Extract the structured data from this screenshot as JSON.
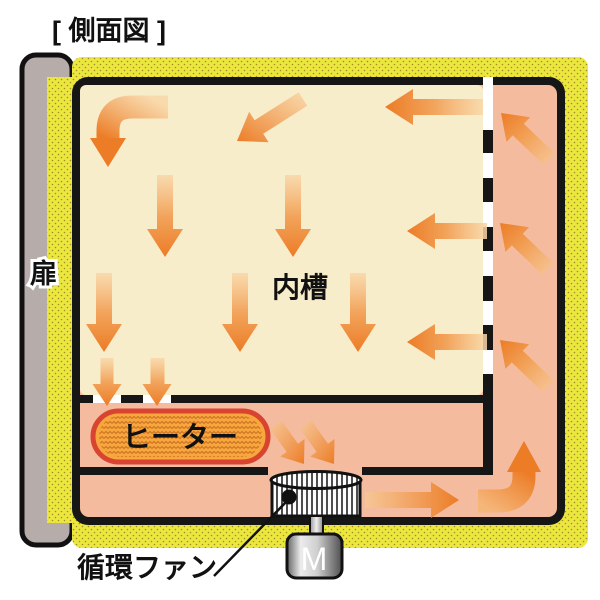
{
  "title": "[ 側面図 ]",
  "labels": {
    "door": "扉",
    "inner_chamber": "内槽",
    "heater": "ヒーター",
    "circulation_fan": "循環ファン",
    "motor": "M"
  },
  "colors": {
    "insulation_yellow": "#ebe73e",
    "insulation_dot": "#a08e24",
    "inner_wall_black": "#161616",
    "plenum_salmon": "#f4bb9f",
    "chamber_cream": "#f8edcb",
    "arrow_orange_dark": "#ec7c26",
    "arrow_orange_light": "#f9d7a8",
    "heater_fill": "#f7a73d",
    "heater_border": "#d84430",
    "door_gray": "#b6adaa"
  }
}
